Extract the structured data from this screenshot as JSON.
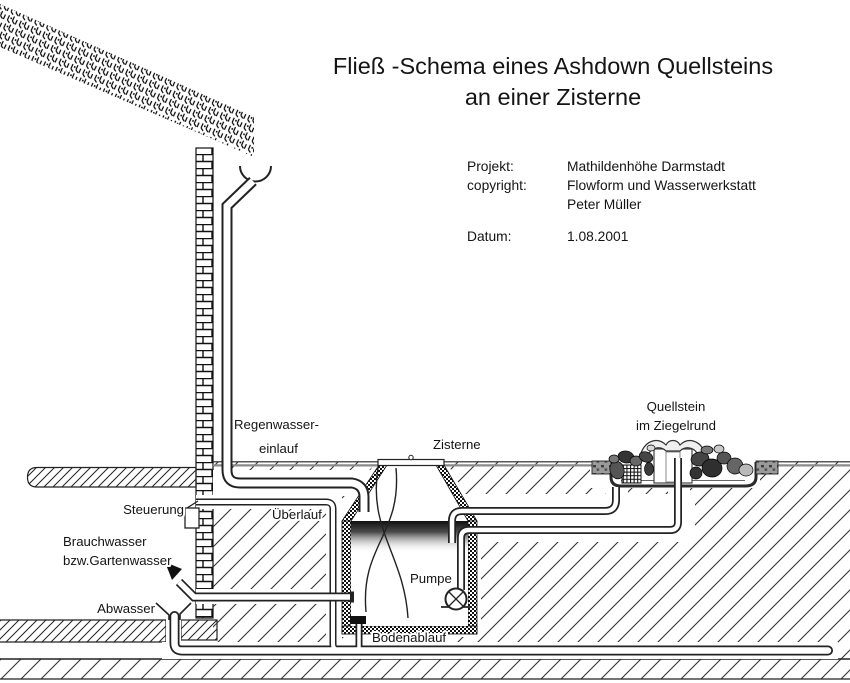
{
  "title": {
    "line1": "Fließ -Schema eines Ashdown Quellsteins",
    "line2": "an einer Zisterne"
  },
  "meta": {
    "projekt_label": "Projekt:",
    "projekt_value": "Mathildenhöhe Darmstadt",
    "copyright_label": "copyright:",
    "copyright_value1": "Flowform und Wasserwerkstatt",
    "copyright_value2": "Peter Müller",
    "datum_label": "Datum:",
    "datum_value": "1.08.2001"
  },
  "labels": {
    "regenwasser1": "Regenwasser-",
    "regenwasser2": "einlauf",
    "zisterne": "Zisterne",
    "quellstein1": "Quellstein",
    "quellstein2": "im Ziegelrund",
    "steuerung": "Steuerung",
    "ueberlauf": "Überlauf",
    "brauchwasser1": "Brauchwasser",
    "brauchwasser2": "bzw.Gartenwasser",
    "abwasser": "Abwasser",
    "pumpe": "Pumpe",
    "bodenablauf": "Bodenablauf"
  },
  "colors": {
    "ink": "#1a1a1a",
    "soil_hatch": "#333333",
    "pipe_outline": "#2b2b2b",
    "ground_gray": "#8a8a8a",
    "water_dark": "#111111",
    "background": "#ffffff"
  }
}
